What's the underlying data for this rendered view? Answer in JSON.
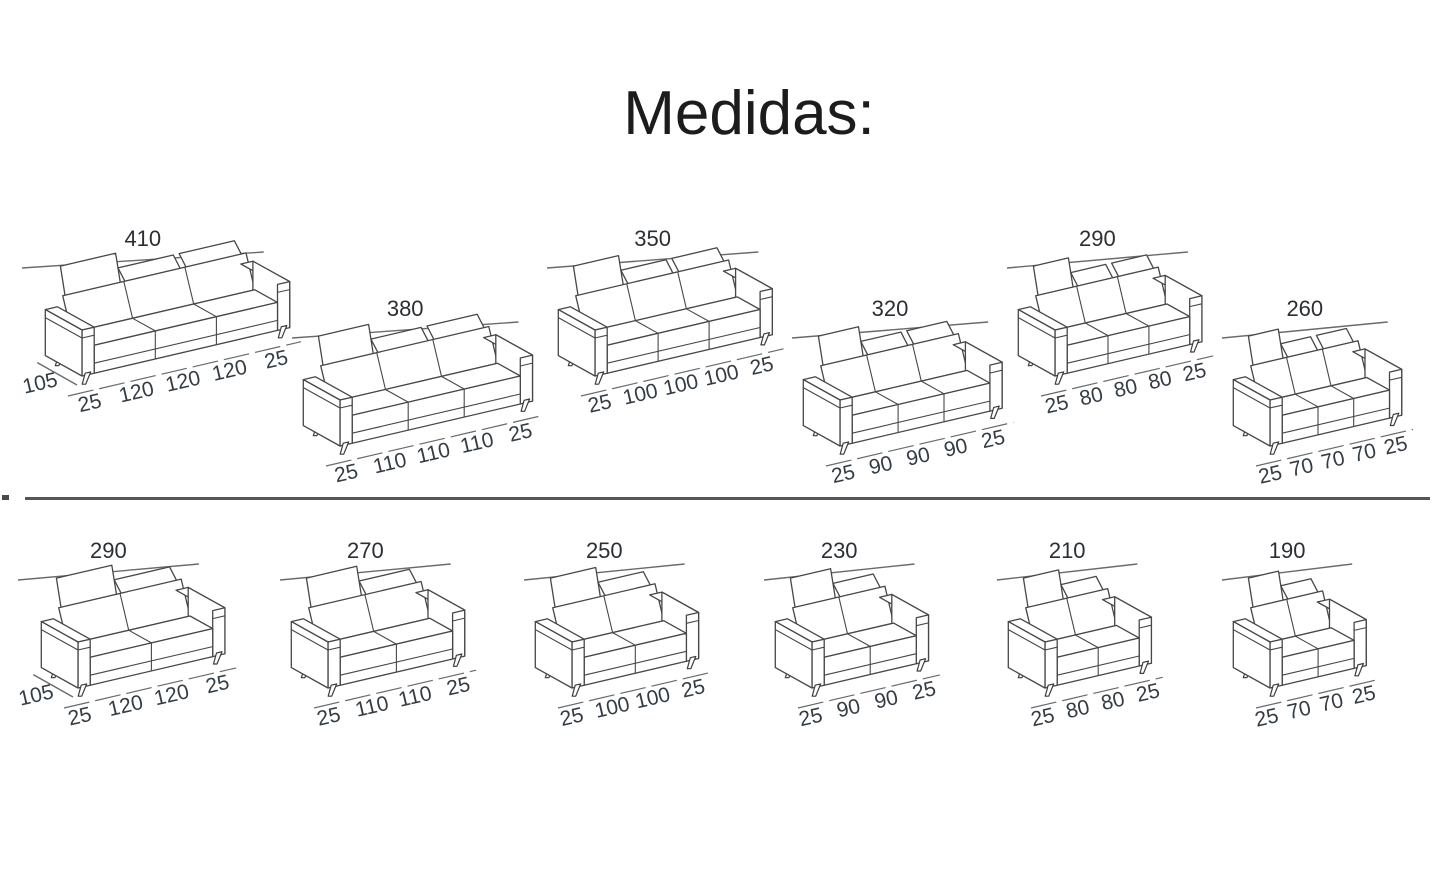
{
  "title": "Medidas:",
  "rows": {
    "top": [
      {
        "total": "410",
        "depth": "105",
        "segments": [
          "25",
          "120",
          "120",
          "120",
          "25"
        ]
      },
      {
        "total": "380",
        "segments": [
          "25",
          "110",
          "110",
          "110",
          "25"
        ]
      },
      {
        "total": "350",
        "segments": [
          "25",
          "100",
          "100",
          "100",
          "25"
        ]
      },
      {
        "total": "320",
        "segments": [
          "25",
          "90",
          "90",
          "90",
          "25"
        ]
      },
      {
        "total": "290",
        "segments": [
          "25",
          "80",
          "80",
          "80",
          "25"
        ]
      },
      {
        "total": "260",
        "segments": [
          "25",
          "70",
          "70",
          "70",
          "25"
        ]
      }
    ],
    "bottom": [
      {
        "total": "290",
        "depth": "105",
        "segments": [
          "25",
          "120",
          "120",
          "25"
        ]
      },
      {
        "total": "270",
        "segments": [
          "25",
          "110",
          "110",
          "25"
        ]
      },
      {
        "total": "250",
        "segments": [
          "25",
          "100",
          "100",
          "25"
        ]
      },
      {
        "total": "230",
        "segments": [
          "25",
          "90",
          "90",
          "25"
        ]
      },
      {
        "total": "210",
        "segments": [
          "25",
          "80",
          "80",
          "25"
        ]
      },
      {
        "total": "190",
        "segments": [
          "25",
          "70",
          "70",
          "25"
        ]
      }
    ]
  }
}
